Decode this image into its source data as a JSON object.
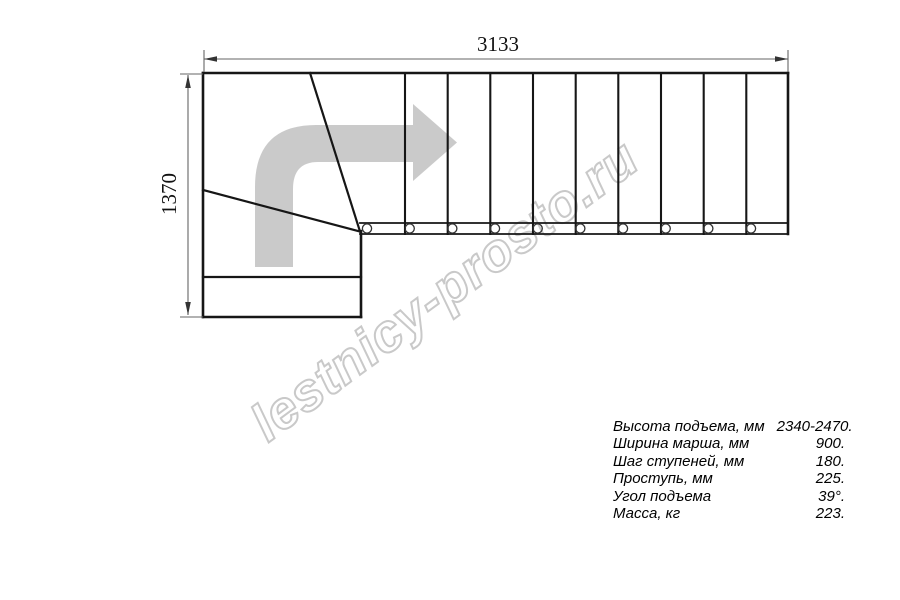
{
  "drawing": {
    "type": "staircase-plan-top-view",
    "dimension_length_mm": "3133",
    "dimension_width_mm": "1370",
    "straight_tread_lines": 9,
    "baluster_circles": 10,
    "colors": {
      "line": "#161616",
      "dimension_line": "#666666",
      "arrow_fill": "#c6c6c6",
      "watermark_stroke": "#c9c9c9",
      "background": "#ffffff"
    }
  },
  "watermark": {
    "text": "lestnicy-prosto.ru"
  },
  "icons": {
    "direction_arrow": "turn-right-arrow"
  },
  "specs": {
    "rows": [
      {
        "label": "Высота подъема, мм",
        "value": "2340-2470."
      },
      {
        "label": "Ширина марша, мм",
        "value": "900."
      },
      {
        "label": "Шаг ступеней, мм",
        "value": "180."
      },
      {
        "label": "Проступь, мм",
        "value": "225."
      },
      {
        "label": "Угол подъема",
        "value": "39°."
      },
      {
        "label": "Масса, кг",
        "value": "223."
      }
    ]
  }
}
